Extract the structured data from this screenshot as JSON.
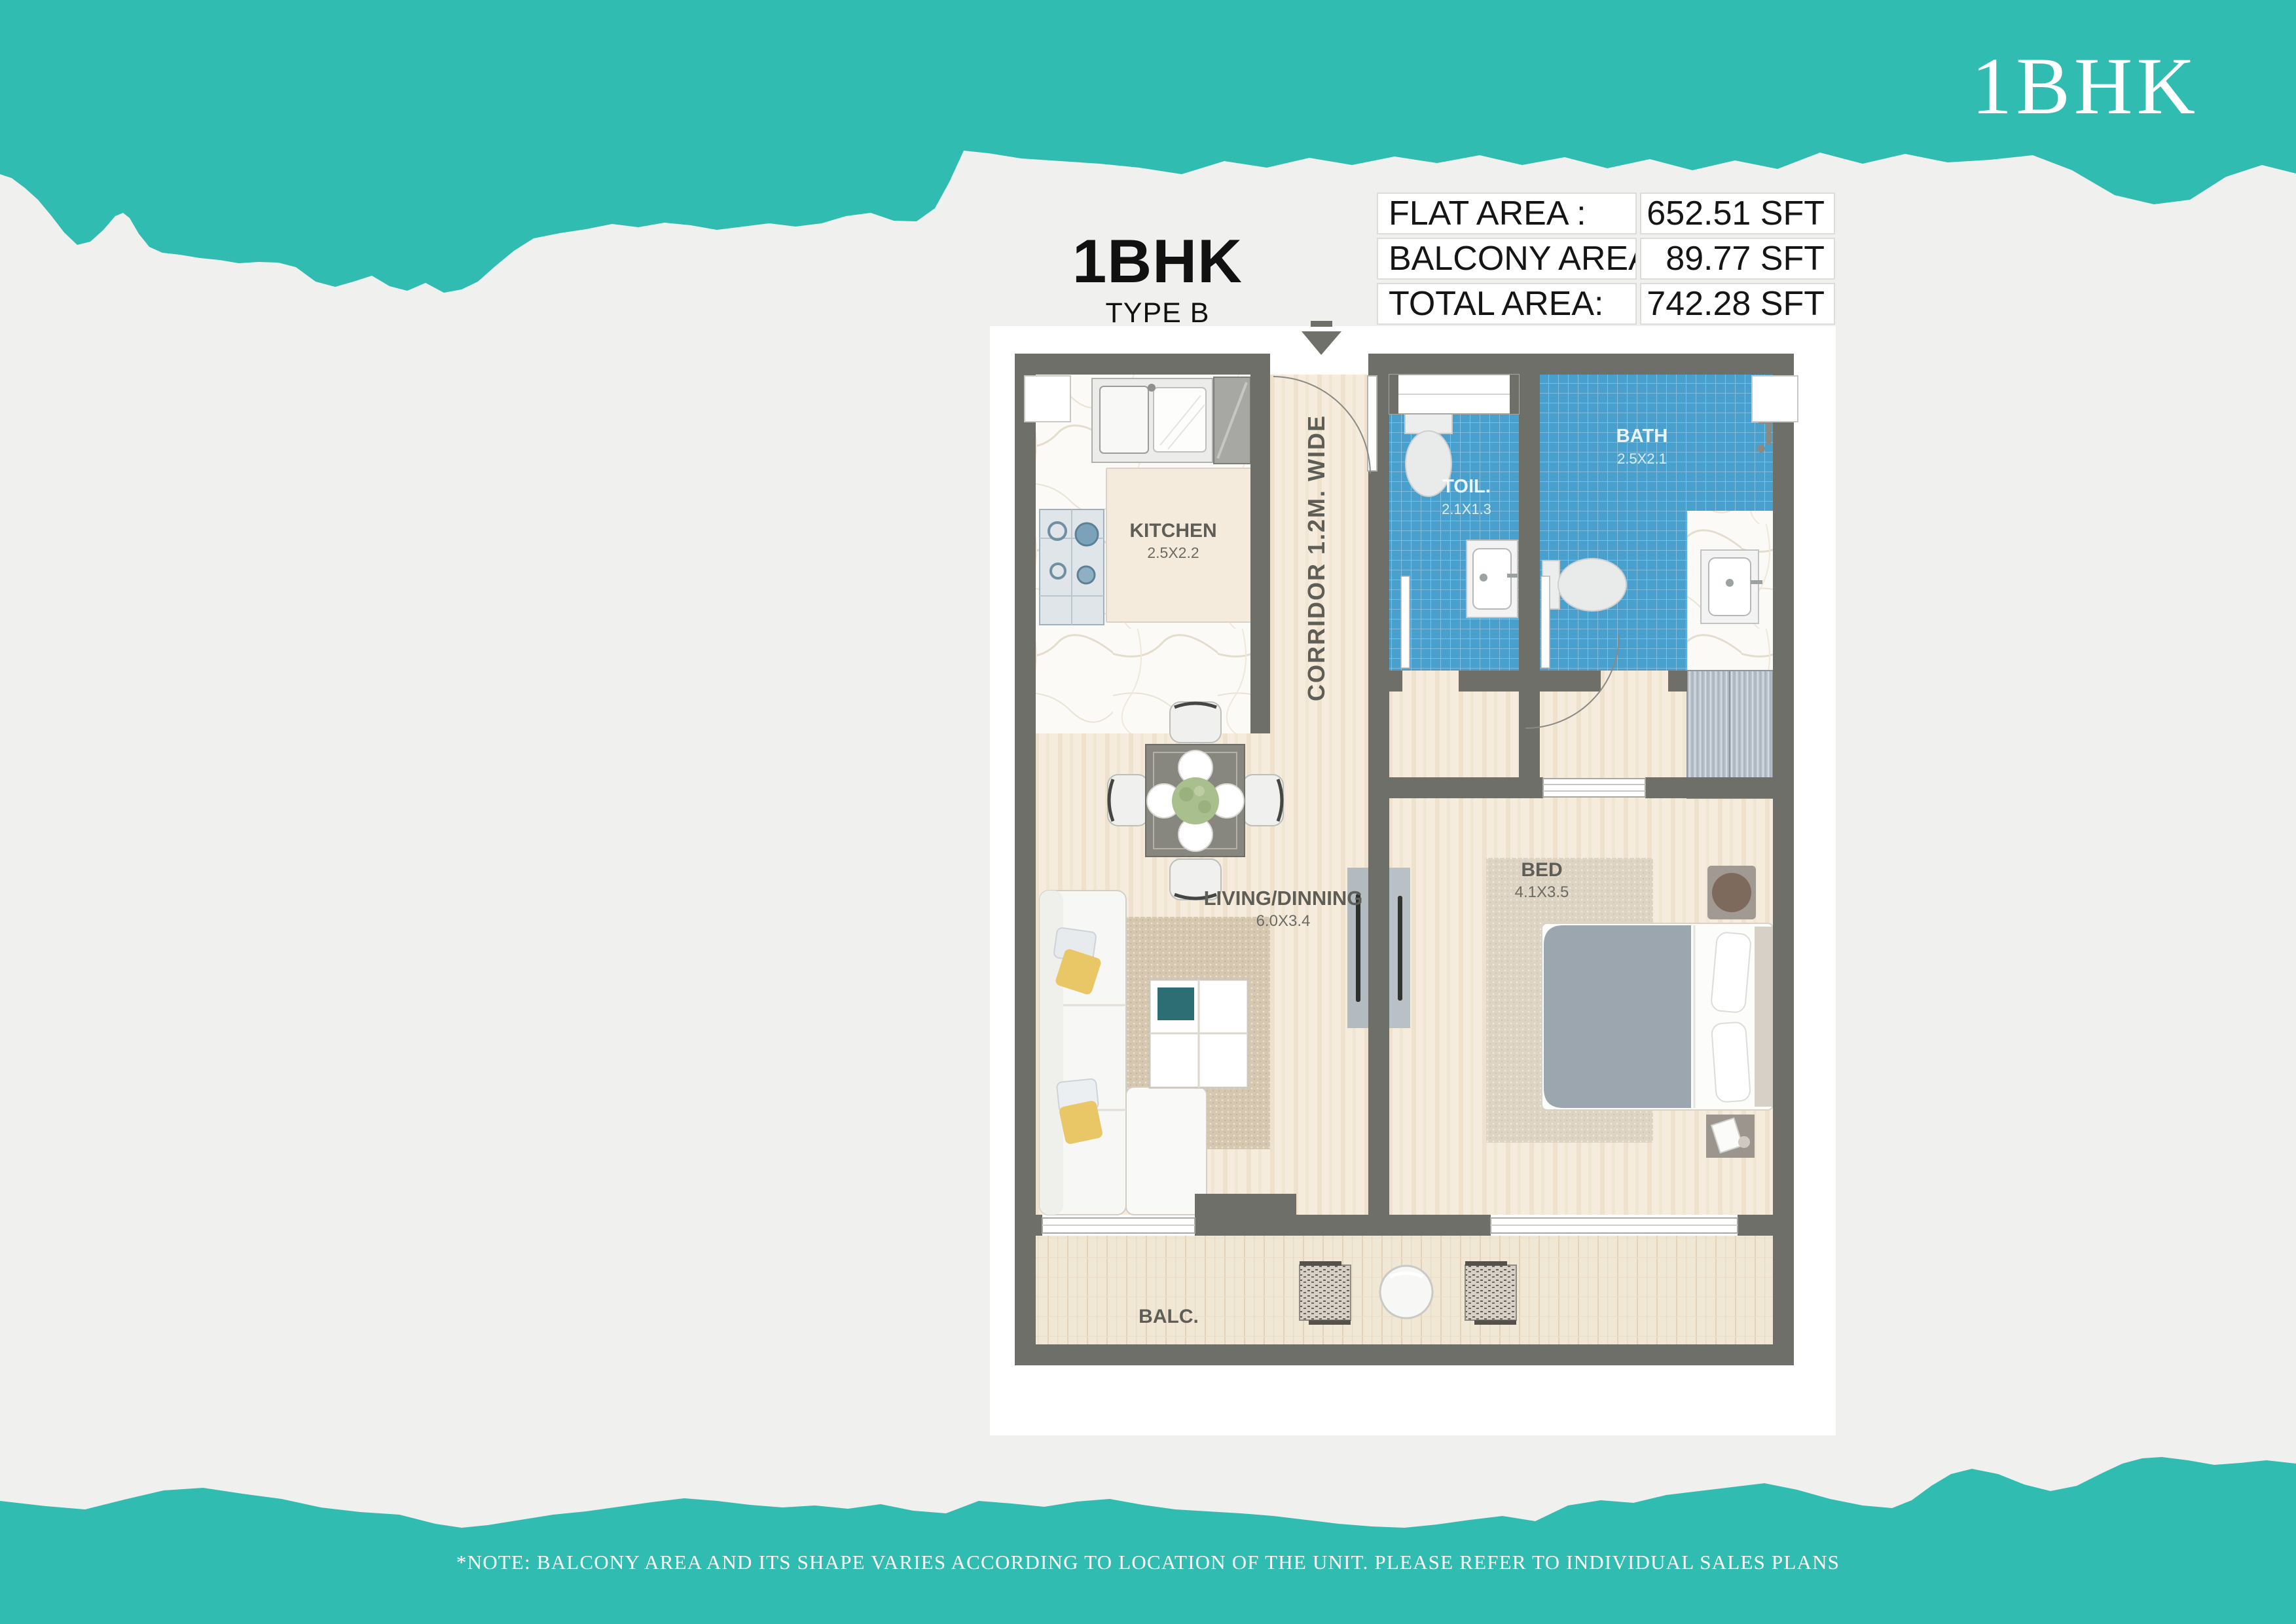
{
  "header": {
    "brand": "1BHK"
  },
  "plan_header": {
    "title": "1BHK",
    "subtitle": "TYPE B"
  },
  "area_table": {
    "rows": [
      {
        "label": "FLAT AREA :",
        "value": "652.51 SFT"
      },
      {
        "label": "BALCONY AREA :",
        "value": "89.77 SFT"
      },
      {
        "label": "TOTAL AREA:",
        "value": "742.28 SFT"
      }
    ]
  },
  "rooms": {
    "kitchen": {
      "label": "KITCHEN",
      "dims": "2.5X2.2"
    },
    "corridor": {
      "label": "CORRIDOR 1.2M. WIDE"
    },
    "toilet": {
      "label": "TOIL.",
      "dims": "2.1X1.3"
    },
    "bath": {
      "label": "BATH",
      "dims": "2.5X2.1"
    },
    "living": {
      "label": "LIVING/DINNING",
      "dims": "6.0X3.4"
    },
    "bedroom": {
      "label": "BED",
      "dims": "4.1X3.5"
    },
    "balcony": {
      "label": "BALC."
    }
  },
  "colors": {
    "teal": "#31bcb1",
    "wall": "#6f6f69",
    "tile_blue": "#4aa0cd",
    "background": "#f0f0ee"
  },
  "footer": {
    "note": "*NOTE: BALCONY AREA AND ITS SHAPE VARIES ACCORDING TO LOCATION OF THE UNIT. PLEASE REFER TO INDIVIDUAL SALES PLANS"
  }
}
